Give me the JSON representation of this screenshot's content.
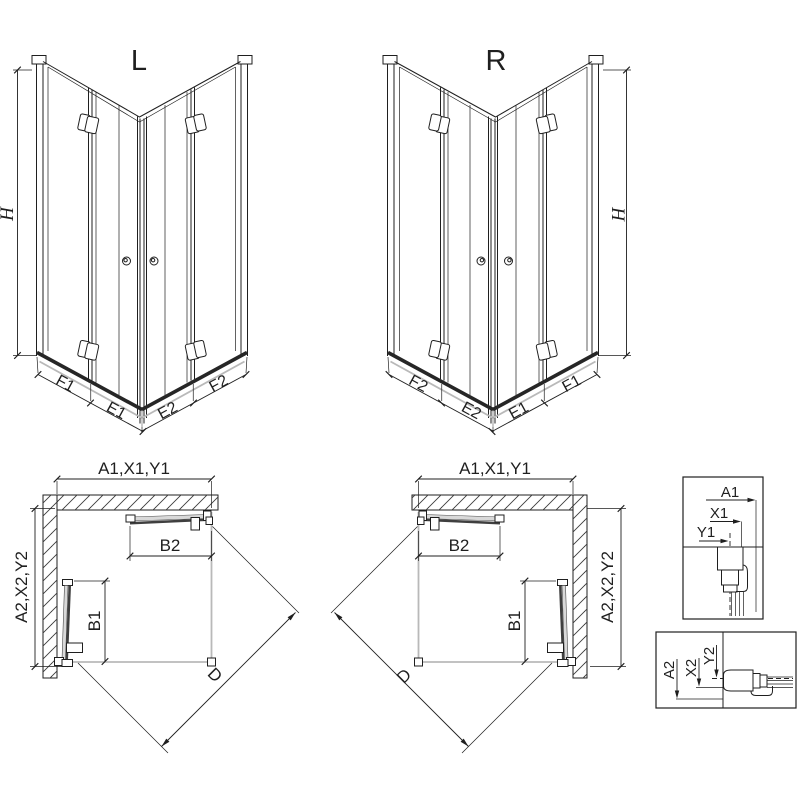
{
  "drawing": {
    "ink_color": "#1f1f1f",
    "view_3d_left": {
      "title": "L",
      "height_label": "H",
      "segment_labels": [
        "F1",
        "E1",
        "E2",
        "F2"
      ]
    },
    "view_3d_right": {
      "title": "R",
      "height_label": "H",
      "segment_labels": [
        "F2",
        "E2",
        "E1",
        "F1"
      ]
    },
    "plan_left": {
      "width_label": "A1,X1,Y1",
      "depth_label": "A2,X2,Y2",
      "top_door_label": "B2",
      "side_door_label": "B1",
      "diagonal_label": "D"
    },
    "plan_right": {
      "width_label": "A1,X1,Y1",
      "depth_label": "A2,X2,Y2",
      "top_door_label": "B2",
      "side_door_label": "B1",
      "diagonal_label": "D"
    },
    "detail_front_profile": {
      "labels": [
        "A1",
        "X1",
        "Y1"
      ]
    },
    "detail_side_profile": {
      "labels": [
        "A2",
        "X2",
        "Y2"
      ]
    }
  }
}
